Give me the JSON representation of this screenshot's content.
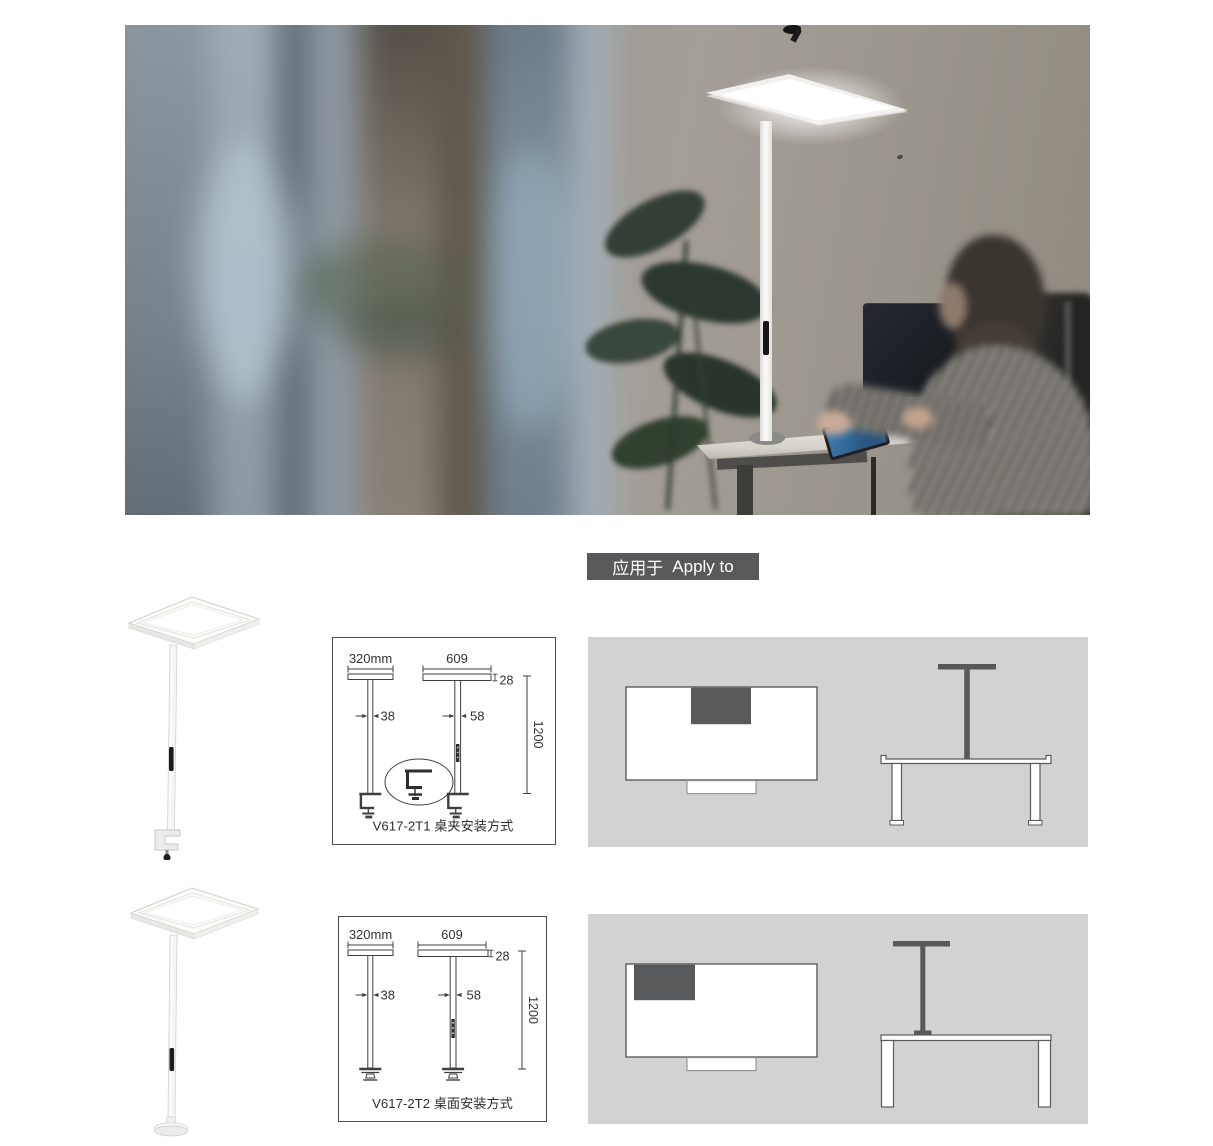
{
  "apply_to": {
    "zh": "应用于",
    "en": "Apply to"
  },
  "products": [
    {
      "model": "V617-2T1",
      "mount_type_label": "V617-2T1 桌夹安装方式",
      "dimensions": {
        "head_side_width": "320mm",
        "head_front_width": "609",
        "head_thickness": "28",
        "pole_side_depth": "38",
        "pole_front_width": "58",
        "mount_height": "1200"
      }
    },
    {
      "model": "V617-2T2",
      "mount_type_label": "V617-2T2 桌面安装方式",
      "dimensions": {
        "head_side_width": "320mm",
        "head_front_width": "609",
        "head_thickness": "28",
        "pole_side_depth": "38",
        "pole_front_width": "58",
        "mount_height": "1200"
      }
    }
  ],
  "colors": {
    "apply_to_bg": "#59595b",
    "apply_to_text": "#ffffff",
    "panel_bg": "#d2d2d3",
    "diagram_dark": "#58595b",
    "drawing_stroke": "#3f3f3f"
  }
}
